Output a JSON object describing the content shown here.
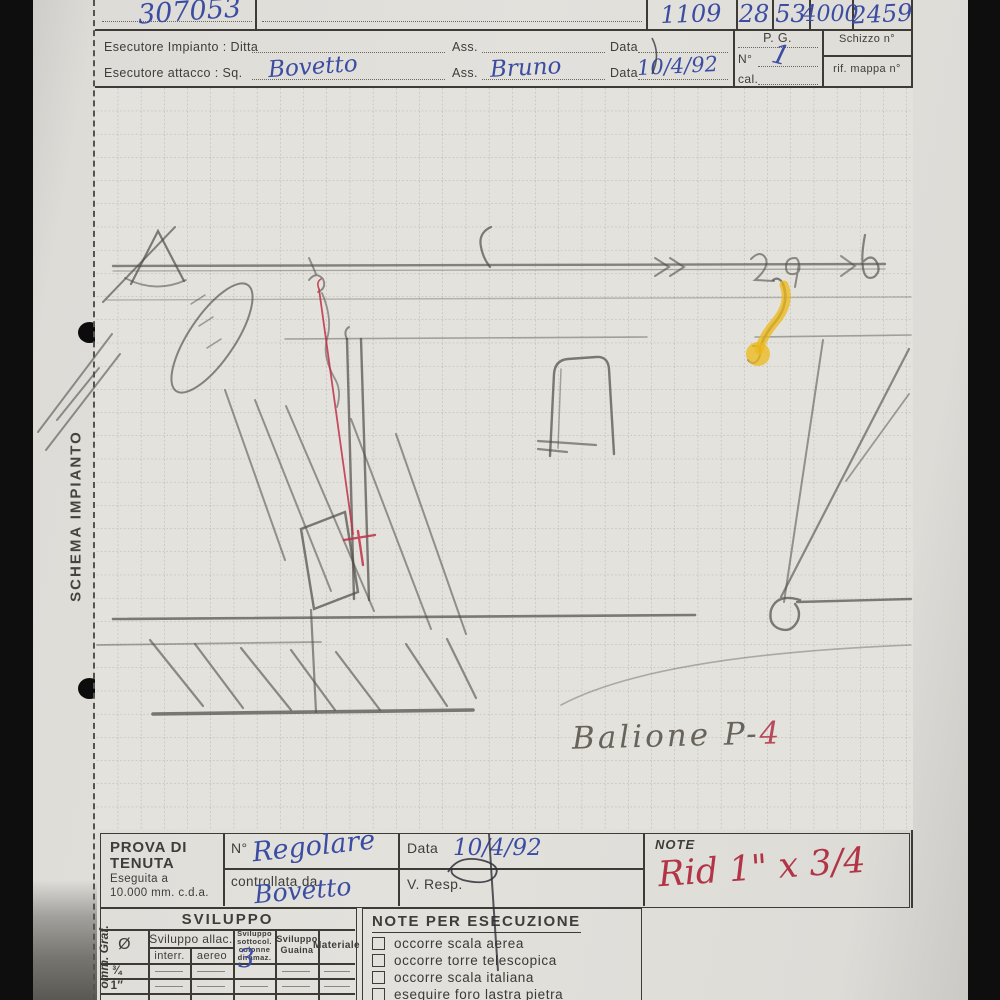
{
  "page": {
    "serial": "307053",
    "codes": [
      "1109",
      "28",
      "53",
      "4000",
      "2459"
    ]
  },
  "header": {
    "esecutore_impianto_label": "Esecutore Impianto : Ditta",
    "ass_label": "Ass.",
    "data_label": "Data",
    "esecutore_attacco_label": "Esecutore attacco : Sq.",
    "sq_value": "Bovetto",
    "ass_value": "Bruno",
    "data_value": "10/4/92",
    "pg_label": "P. G.",
    "n_label": "N°",
    "n_value": "1",
    "cal_label": "cal.",
    "schizzo_label": "Schizzo n°",
    "mappa_label": "rif. mappa n°"
  },
  "margins": {
    "schema_title": "SCHEMA IMPIANTO",
    "bottom_stamp": "omm. Graf."
  },
  "sketch": {
    "annotation_pencil": "Balione P-",
    "annotation_red": "4"
  },
  "prova": {
    "title_line1": "PROVA DI",
    "title_line2": "TENUTA",
    "subtitle_line1": "Eseguita a",
    "subtitle_line2": "10.000 mm. c.d.a.",
    "n_label": "N°",
    "n_value": "Regolare",
    "controllata_label": "controllata da",
    "controllata_value": "Bovetto",
    "data_label": "Data",
    "data_value": "10/4/92",
    "vresp_label": "V. Resp.",
    "note_label": "NOTE",
    "note_value": "Rid 1\" x 3/4"
  },
  "sviluppo": {
    "title": "SVILUPPO",
    "col_diametro": "Ø",
    "col_allac": "Sviluppo allac.",
    "col_interr": "interr.",
    "col_aereo": "aereo",
    "col_sottosuolo": "Sviluppo sottocol. colonne diramaz.",
    "col_guaina": "Sviluppo Guaina",
    "col_materiale": "Materiale",
    "row1_diam": "¾",
    "row2_diam": "1″",
    "handwritten": "3"
  },
  "esecuzione": {
    "title": "NOTE PER ESECUZIONE",
    "items": [
      "occorre scala aerea",
      "occorre torre telescopica",
      "occorre scala italiana",
      "eseguire foro lastra pietra"
    ]
  }
}
